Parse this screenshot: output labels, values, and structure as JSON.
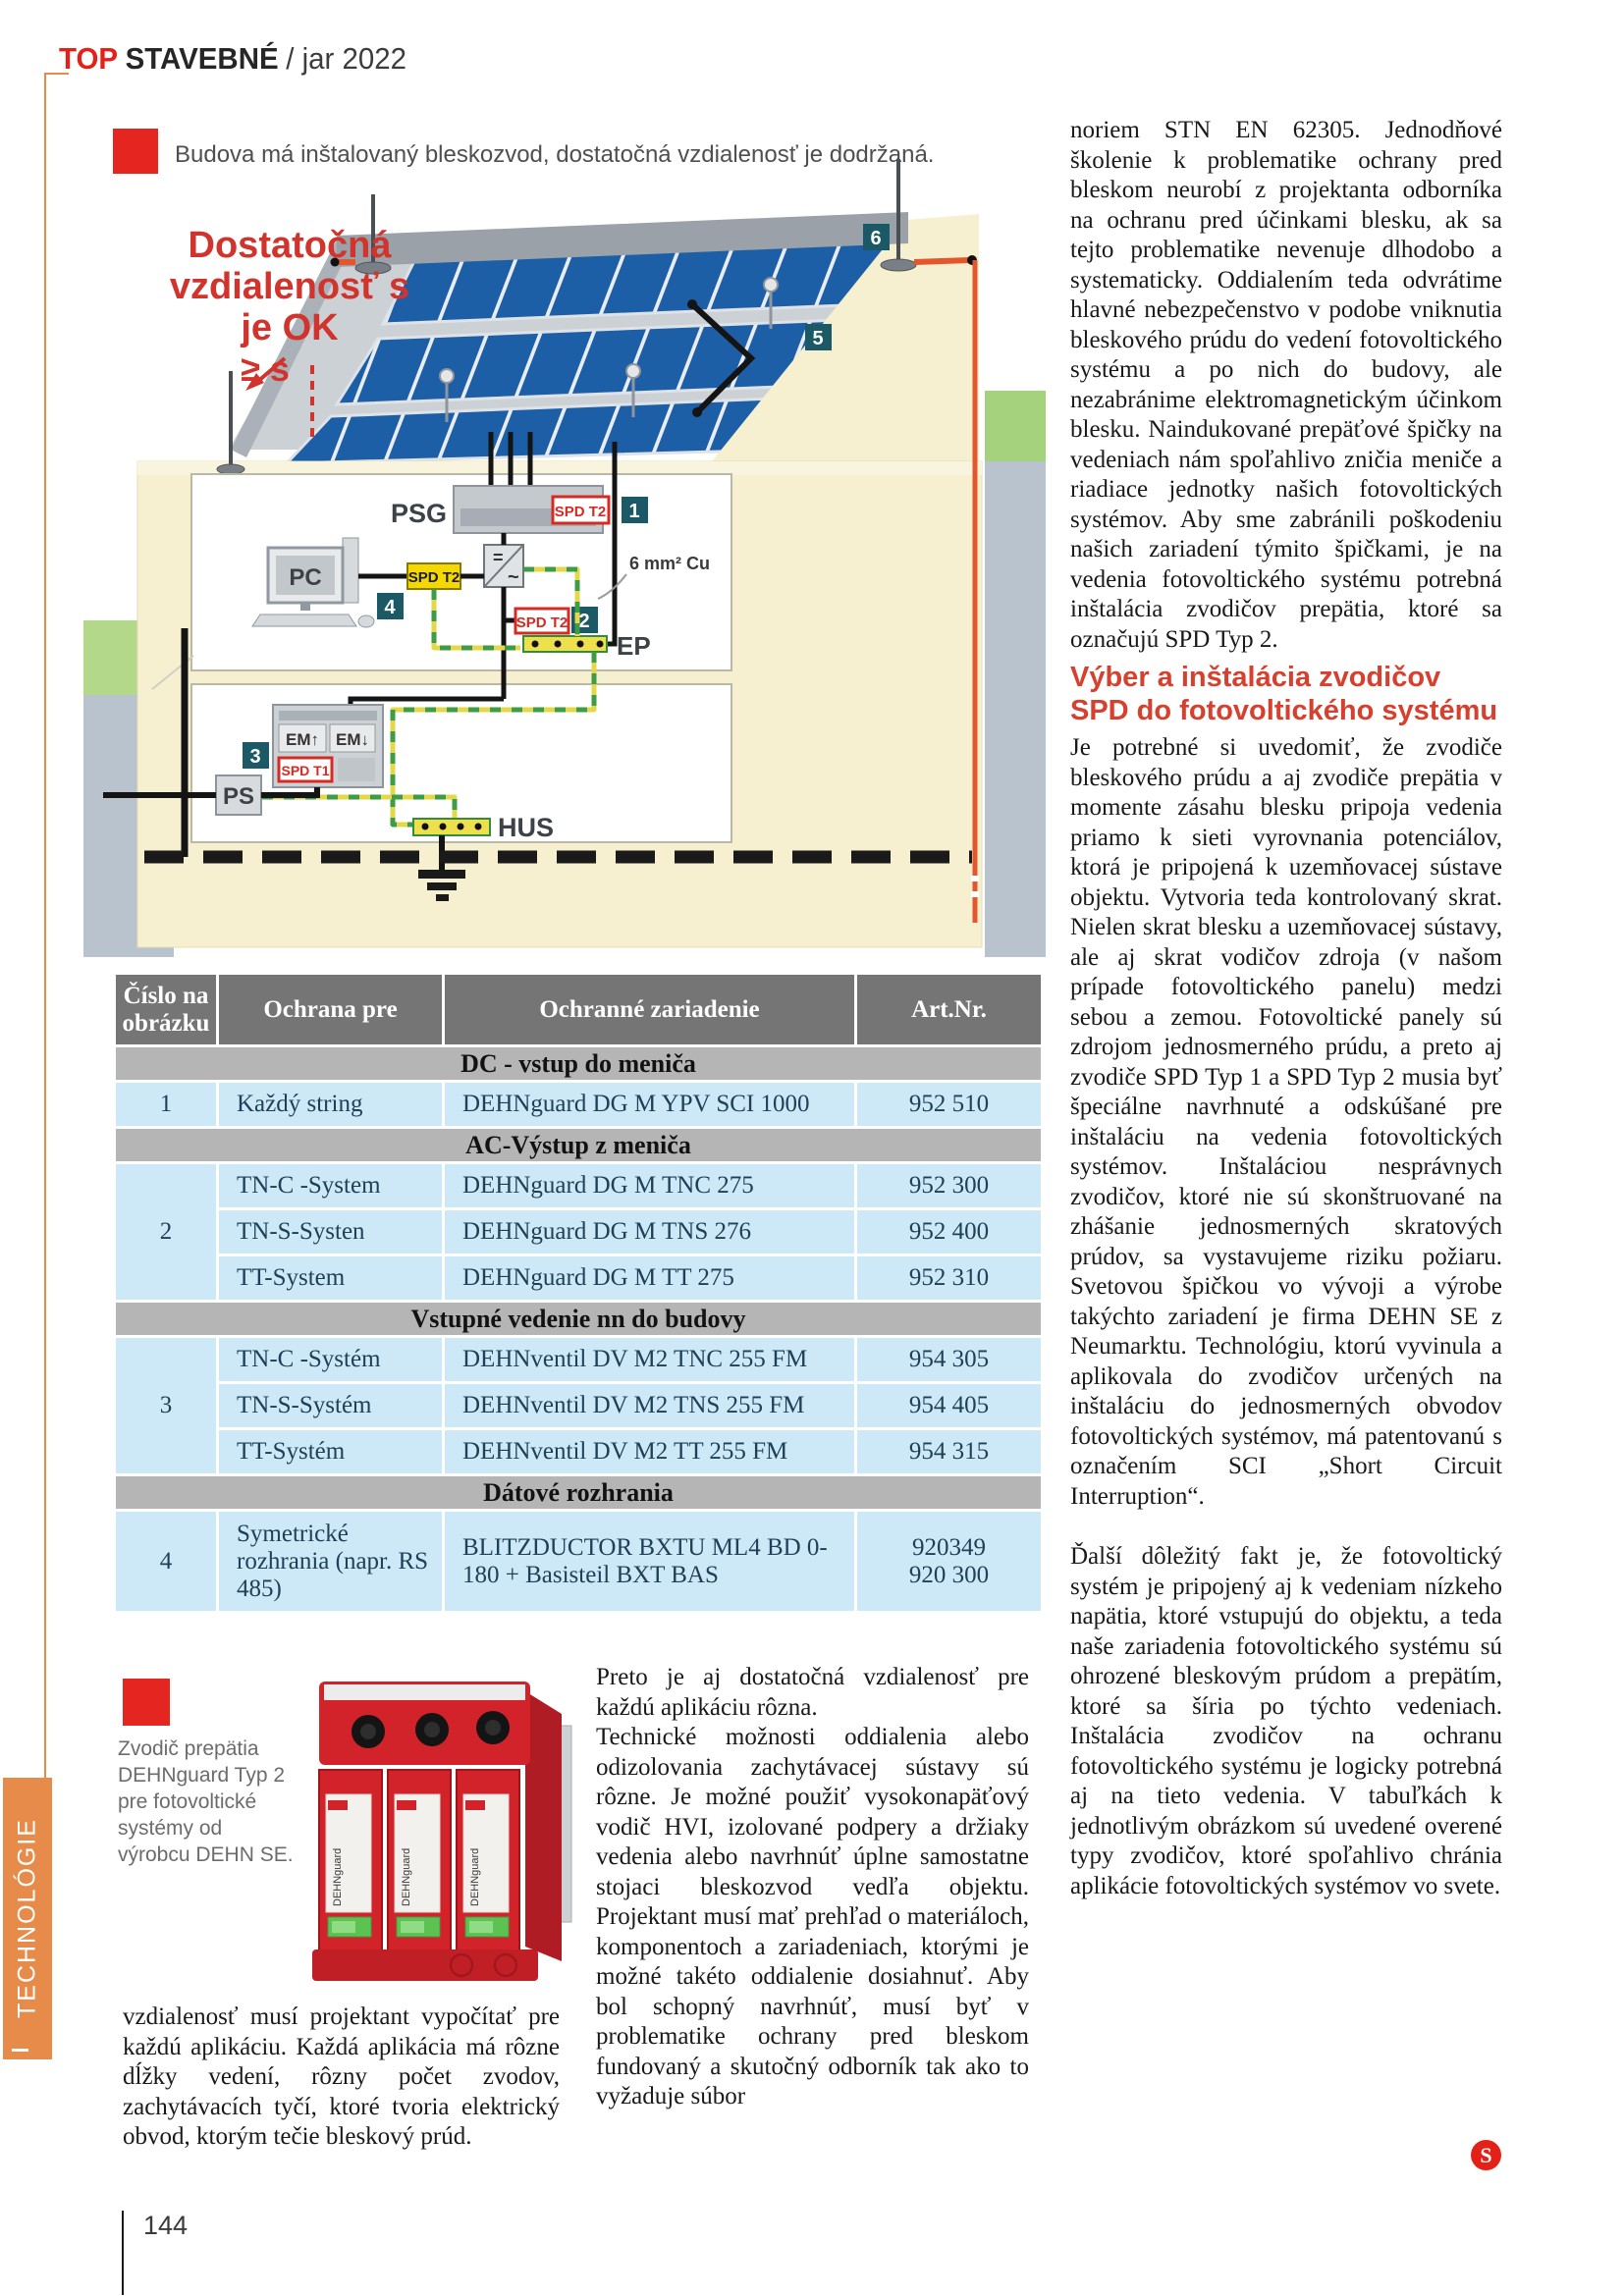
{
  "theme": {
    "accent_red": "#e32119",
    "heading_red": "#d6402f",
    "accent_orange": "#e78b4b",
    "table_header_gray": "#757575",
    "table_section_gray": "#b5b5b5",
    "table_row_blue": "#cde8f6",
    "badge_teal": "#1a5965"
  },
  "header": {
    "brand_top": "TOP",
    "brand_name": "STAVEBNÉ",
    "issue": "/ jar 2022"
  },
  "sidebar": {
    "section": "TECHNOLÓGIE"
  },
  "footer": {
    "page_number": "144"
  },
  "figure": {
    "caption": "Budova má inštalovaný bleskozvod, dostatočná vzdialenosť je dodržaná.",
    "note": {
      "l1": "Dostatočná",
      "l2": "vzdialenosť s",
      "l3": "je OK",
      "l4": "≥ s"
    },
    "labels": {
      "psg": "PSG",
      "pc": "PC",
      "spd_t2": "SPD T2",
      "spd_t1": "SPD T1",
      "em_up": "EM↑",
      "em_down": "EM↓",
      "ps": "PS",
      "ep": "EP",
      "hus": "HUS",
      "cu": "6 mm² Cu",
      "inv_dc": "=",
      "inv_ac": "~"
    },
    "badges": {
      "b1": "1",
      "b2": "2",
      "b3": "3",
      "b4": "4",
      "b5": "5",
      "b6": "6"
    }
  },
  "table": {
    "col_cislo": "Číslo na obrázku",
    "col_ochrana": "Ochrana pre",
    "col_zariadenie": "Ochranné zariadenie",
    "col_art": "Art.Nr.",
    "s1": {
      "title": "DC - vstup do meniča",
      "r1": {
        "num": "1",
        "pre": "Každý string",
        "dev": "DEHNguard DG M YPV SCI 1000",
        "art": "952 510"
      }
    },
    "s2": {
      "title": "AC-Výstup z meniča",
      "num": "2",
      "r1": {
        "pre": "TN-C -System",
        "dev": "DEHNguard DG M TNC 275",
        "art": "952 300"
      },
      "r2": {
        "pre": "TN-S-Systen",
        "dev": "DEHNguard DG M TNS 276",
        "art": "952 400"
      },
      "r3": {
        "pre": "TT-System",
        "dev": "DEHNguard DG M TT 275",
        "art": "952 310"
      }
    },
    "s3": {
      "title": "Vstupné vedenie nn do budovy",
      "num": "3",
      "r1": {
        "pre": "TN-C -Systém",
        "dev": "DEHNventil DV M2 TNC 255 FM",
        "art": "954 305"
      },
      "r2": {
        "pre": "TN-S-Systém",
        "dev": "DEHNventil DV M2 TNS 255 FM",
        "art": "954 405"
      },
      "r3": {
        "pre": "TT-Systém",
        "dev": "DEHNventil DV M2 TT 255 FM",
        "art": "954 315"
      }
    },
    "s4": {
      "title": "Dátové rozhrania",
      "r1": {
        "num": "4",
        "pre": "Symetrické rozhrania (napr. RS 485)",
        "dev": "BLITZDUCTOR BXTU ML4 BD 0-180 + Basisteil BXT BAS",
        "art": "920349\n920 300"
      }
    }
  },
  "photo": {
    "caption": "Zvodič prepätia DEHNguard Typ 2 pre fotovoltické systémy od výrobcu DEHN SE.",
    "device_label": "DEHNguard"
  },
  "article": {
    "left_col": "vzdialenosť musí projektant vypočítať pre každú aplikáciu. Každá aplikácia má rôzne dĺžky vedení, rôzny počet zvodov, zachytávacích tyčí, ktoré tvoria elektrický obvod, ktorým tečie bleskový prúd.",
    "mid_p1": "Preto je aj dostatočná vzdialenosť pre každú aplikáciu rôzna.",
    "mid_p2": "Technické možnosti oddialenia alebo odizolovania zachytávacej sústavy sú rôzne. Je možné použiť vysokonapäťový vodič HVI, izolované podpery a držiaky vedenia alebo navrhnúť úplne samostatne stojaci bleskozvod vedľa objektu. Projektant musí mať prehľad o materiáloch, komponentoch a zariadeniach, ktorými je možné takéto oddialenie dosiahnuť. Aby bol schopný navrhnúť, musí byť v problematike ochrany pred bleskom fundovaný a skutočný odborník tak ako to vyžaduje súbor",
    "right_p1": "noriem STN EN 62305. Jednodňové školenie k problematike ochrany pred bleskom neurobí z projektanta odborníka na ochranu pred účinkami blesku, ak sa tejto problematike nevenuje dlhodobo a systematicky. Oddialením teda odvrátime hlavné nebezpečenstvo v podobe vniknutia bleskového prúdu do vedení fotovoltického systému a po nich do budovy, ale nezabránime elektromagnetickým účinkom blesku. Naindukované prepäťové špičky na vedeniach nám spoľahlivo zničia meniče a riadiace jednotky našich fotovoltických systémov. Aby sme zabránili poškodeniu našich zariadení týmito špičkami, je na vedenia fotovoltického systému potrebná inštalácia zvodičov prepätia, ktoré sa označujú SPD Typ 2.",
    "right_heading": "Výber a inštalácia zvodičov SPD do fotovoltického systému",
    "right_p2": "Je potrebné si uvedomiť, že zvodiče bleskového prúdu a aj zvodiče prepätia v momente zásahu blesku pripoja vedenia priamo k sieti vyrovnania potenciálov, ktorá je pripojená k uzemňovacej sústave objektu. Vytvoria teda kontrolovaný skrat. Nielen skrat blesku a uzemňovacej sústavy, ale aj skrat vodičov zdroja (v našom prípade fotovoltického panelu) medzi sebou a zemou. Fotovoltické panely sú zdrojom jednosmerného prúdu, a preto aj zvodiče SPD Typ 1 a SPD Typ 2 musia byť špeciálne navrhnuté a odskúšané pre inštaláciu na vedenia fotovoltických systémov. Inštaláciou nesprávnych zvodičov, ktoré nie sú skonštruované na zhášanie jednosmerných skratových prúdov, sa vystavujeme riziku požiaru. Svetovou špičkou vo vývoji a výrobe takýchto zariadení je firma DEHN SE z Neumarktu. Technológiu, ktorú vyvinula a aplikovala do zvodičov určených na inštaláciu do jednosmerných obvodov fotovoltických systémov, má patentovanú s označením SCI „Short Circuit Interruption“.",
    "right_p3": "Ďalší dôležitý fakt je, že fotovoltický systém je pripojený aj k vedeniam nízkeho napätia, ktoré vstupujú do objektu, a teda naše zariadenia fotovoltického systému sú ohrozené bleskovým prúdom a prepätím, ktoré sa šíria po týchto vedeniach. Inštalácia zvodičov na ochranu fotovoltického systému je logicky potrebná aj na tieto vedenia. V tabuľkách k jednotlivým obrázkom sú uvedené overené typy zvodičov, ktoré spoľahlivo chránia aplikácie fotovoltických systémov vo svete.",
    "end_mark": "S"
  }
}
